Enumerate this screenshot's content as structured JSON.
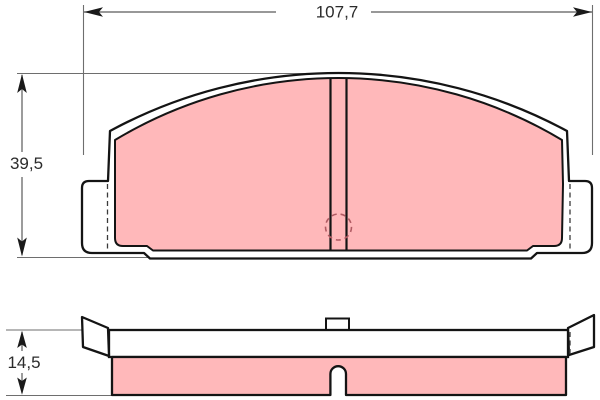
{
  "drawing": {
    "title": "brake-pad-technical-drawing",
    "dimensions": {
      "width_label": "107,7",
      "height_label": "39,5",
      "thickness_label": "14,5"
    },
    "colors": {
      "friction_material": "#ffb8ba",
      "outline": "#141414",
      "dimension_line": "#5a5a5a",
      "extension_line": "#6e6e6e",
      "arrowhead": "#1a1a1a",
      "hidden_circle": "#b05a62",
      "hidden_edge": "#3a3a3a",
      "background": "#ffffff"
    }
  }
}
